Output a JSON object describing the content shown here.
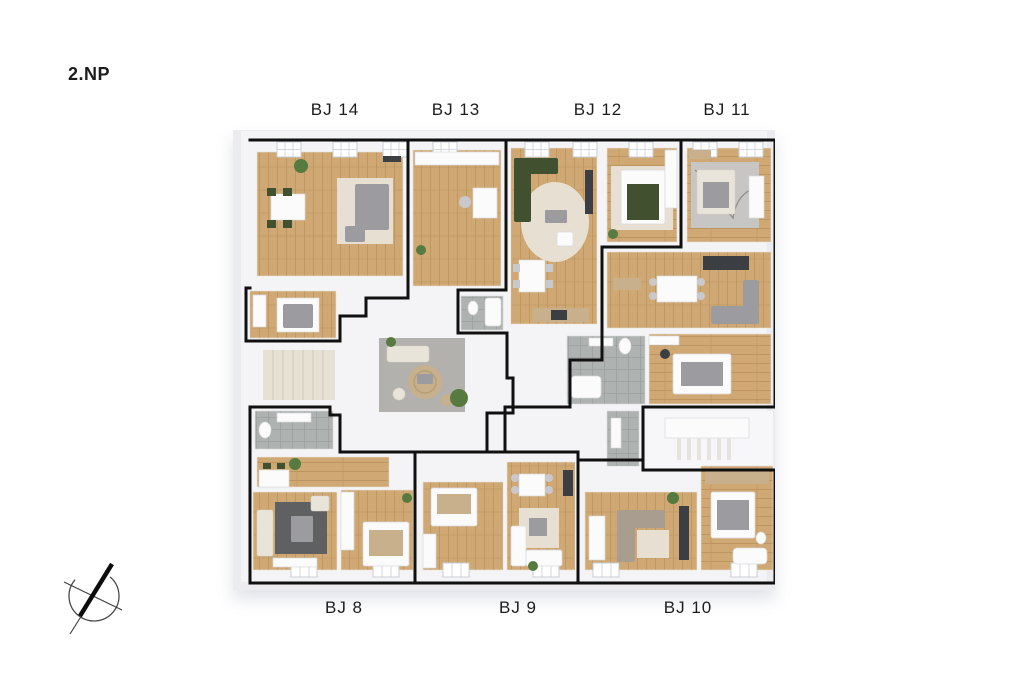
{
  "floor_label": "2.NP",
  "units_top": [
    {
      "label": "BJ 14"
    },
    {
      "label": "BJ 13"
    },
    {
      "label": "BJ 12"
    },
    {
      "label": "BJ 11"
    }
  ],
  "units_bottom": [
    {
      "label": "BJ 8"
    },
    {
      "label": "BJ 9"
    },
    {
      "label": "BJ 10"
    }
  ],
  "compass": {
    "icon": "north-arrow"
  },
  "palette": {
    "page-bg": "#ffffff",
    "text": "#1c1c1c",
    "outline": "#101010",
    "wall": "#f4f4f6",
    "wood": "#cfa873",
    "wood-grain": "#bd9560",
    "tile": "#aeb3b1",
    "tile-line": "#9ba09e",
    "courtyard": "#b3b1ae",
    "rug-cream": "#e6dfd2",
    "rug-dark": "#5e6062",
    "sofa-gray": "#9c9ca0",
    "sofa-cream": "#e9e4da",
    "green-dark": "#41502f",
    "plant": "#567a3f",
    "charcoal": "#3b3e43",
    "jute": "#c7b08b",
    "white-furn": "#fbfbfb",
    "taupe": "#a89d8e",
    "stair": "#e7e1d4",
    "shadow": "rgba(98,110,140,0.20)"
  }
}
